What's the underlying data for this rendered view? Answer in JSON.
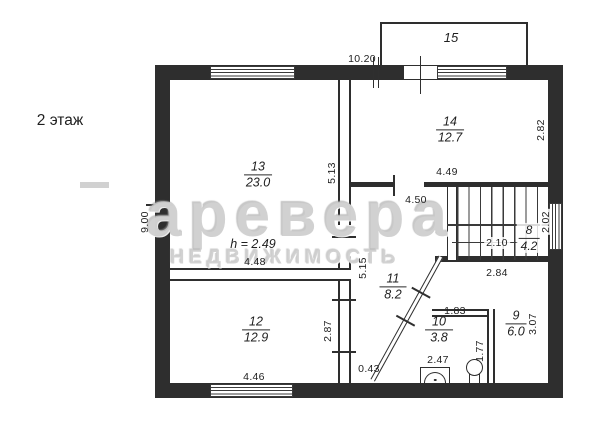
{
  "floor_label": "2 этаж",
  "ceiling_height": "h = 2.49",
  "watermark": {
    "line1": "аревера",
    "line2": "НЕДВИЖИМОСТЬ"
  },
  "rooms": {
    "r15": {
      "number": "15",
      "area": ""
    },
    "r13": {
      "number": "13",
      "area": "23.0"
    },
    "r14": {
      "number": "14",
      "area": "12.7"
    },
    "r12": {
      "number": "12",
      "area": "12.9"
    },
    "r11": {
      "number": "11",
      "area": "8.2"
    },
    "r8": {
      "number": "8",
      "area": "4.2"
    },
    "r9": {
      "number": "9",
      "area": "6.0"
    },
    "r10": {
      "number": "10",
      "area": "3.8"
    }
  },
  "dims": {
    "top_width": "10.20",
    "left_height": "9.00",
    "room13_height": "5.13",
    "hall_height": "5.15",
    "room14_width": "4.49",
    "hall_width": "4.50",
    "room14_height": "2.82",
    "right_window": "2.02",
    "stair_width": "2.10",
    "hall_lower_width": "2.84",
    "room13_width": "4.48",
    "room12_height": "2.87",
    "room12_width": "4.46",
    "bottom_gap": "0.43",
    "bath_top_width": "1.83",
    "bath_width": "2.47",
    "sink_wall": "1.77",
    "room9_height": "3.07"
  },
  "fixtures": {
    "toilet": "toilet",
    "sink": "sink"
  }
}
